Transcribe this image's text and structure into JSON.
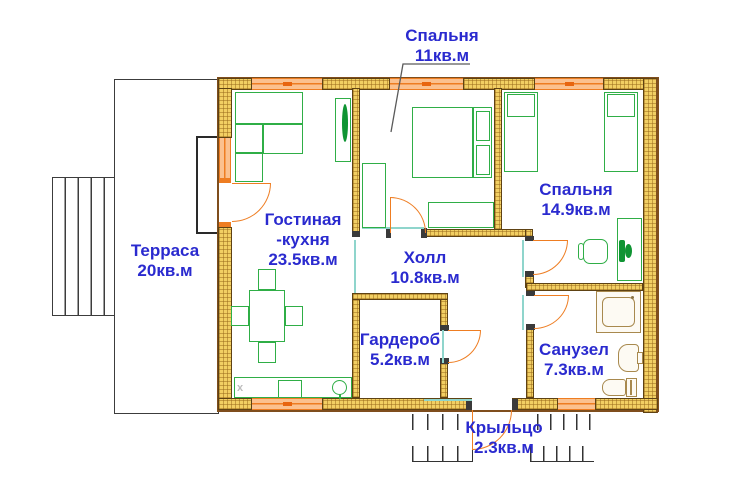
{
  "rooms": {
    "bedroom_top": {
      "name": "Спальня",
      "area": "11кв.м"
    },
    "bedroom_right": {
      "name": "Спальня",
      "area": "14.9кв.м"
    },
    "terrace": {
      "name": "Терраса",
      "area": "20кв.м"
    },
    "living": {
      "name": "Гостиная",
      "name2": "-кухня",
      "area": "23.5кв.м"
    },
    "hall": {
      "name": "Холл",
      "area": "10.8кв.м"
    },
    "wardrobe": {
      "name": "Гардероб",
      "area": "5.2кв.м"
    },
    "bathroom": {
      "name": "Санузел",
      "area": "7.3кв.м"
    },
    "porch": {
      "name": "Крыльцо",
      "area": "2.3кв.м"
    }
  },
  "kitchen_mark": "x",
  "colors": {
    "label_blue": "#2A2ACF",
    "wall_fill": "#F2CF63",
    "wall_outline": "#5E4213",
    "exterior_outline": "#7F4E1D",
    "window_orange": "#EE7D22",
    "window_fill": "#FBC18F",
    "furniture_green": "#2FAE46",
    "fixture_tan": "#A8894E",
    "opening_teal": "#8FD5CC",
    "line_gray": "#3C3C3C"
  }
}
